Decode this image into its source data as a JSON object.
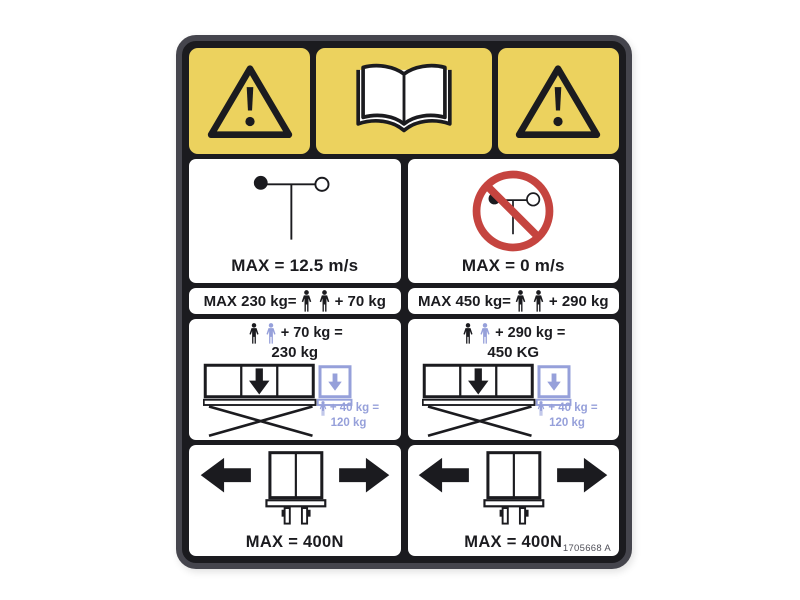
{
  "decal": {
    "part_number": "1705668 A",
    "colors": {
      "band_yellow": "#ecd25e",
      "frame_black": "#1b1b1f",
      "prohibition_red": "#c5443f",
      "extension_blue": "#96a0da"
    },
    "top_band": {
      "icons": [
        "warning-triangle",
        "read-operator-manual-book",
        "warning-triangle"
      ]
    },
    "wind": {
      "allowed": {
        "icon": "anemometer",
        "max_label": "MAX = 12.5 m/s"
      },
      "prohibited": {
        "icon": "anemometer-prohibited",
        "max_label": "MAX = 0 m/s"
      }
    },
    "capacity": {
      "left": {
        "prefix": "MAX 230 kg=",
        "persons": 2,
        "suffix": "+ 70 kg"
      },
      "right": {
        "prefix": "MAX 450 kg=",
        "persons": 2,
        "suffix": "+ 290 kg"
      }
    },
    "platform": {
      "left": {
        "sum": "+ 70 kg =",
        "total": "230 kg",
        "ext_sum": "+ 40 kg =",
        "ext_total": "120 kg"
      },
      "right": {
        "sum": "+ 290 kg =",
        "total": "450 KG",
        "ext_sum": "+ 40 kg =",
        "ext_total": "120 kg"
      }
    },
    "push": {
      "left": {
        "max_label": "MAX = 400N"
      },
      "right": {
        "max_label": "MAX = 400N"
      }
    }
  }
}
